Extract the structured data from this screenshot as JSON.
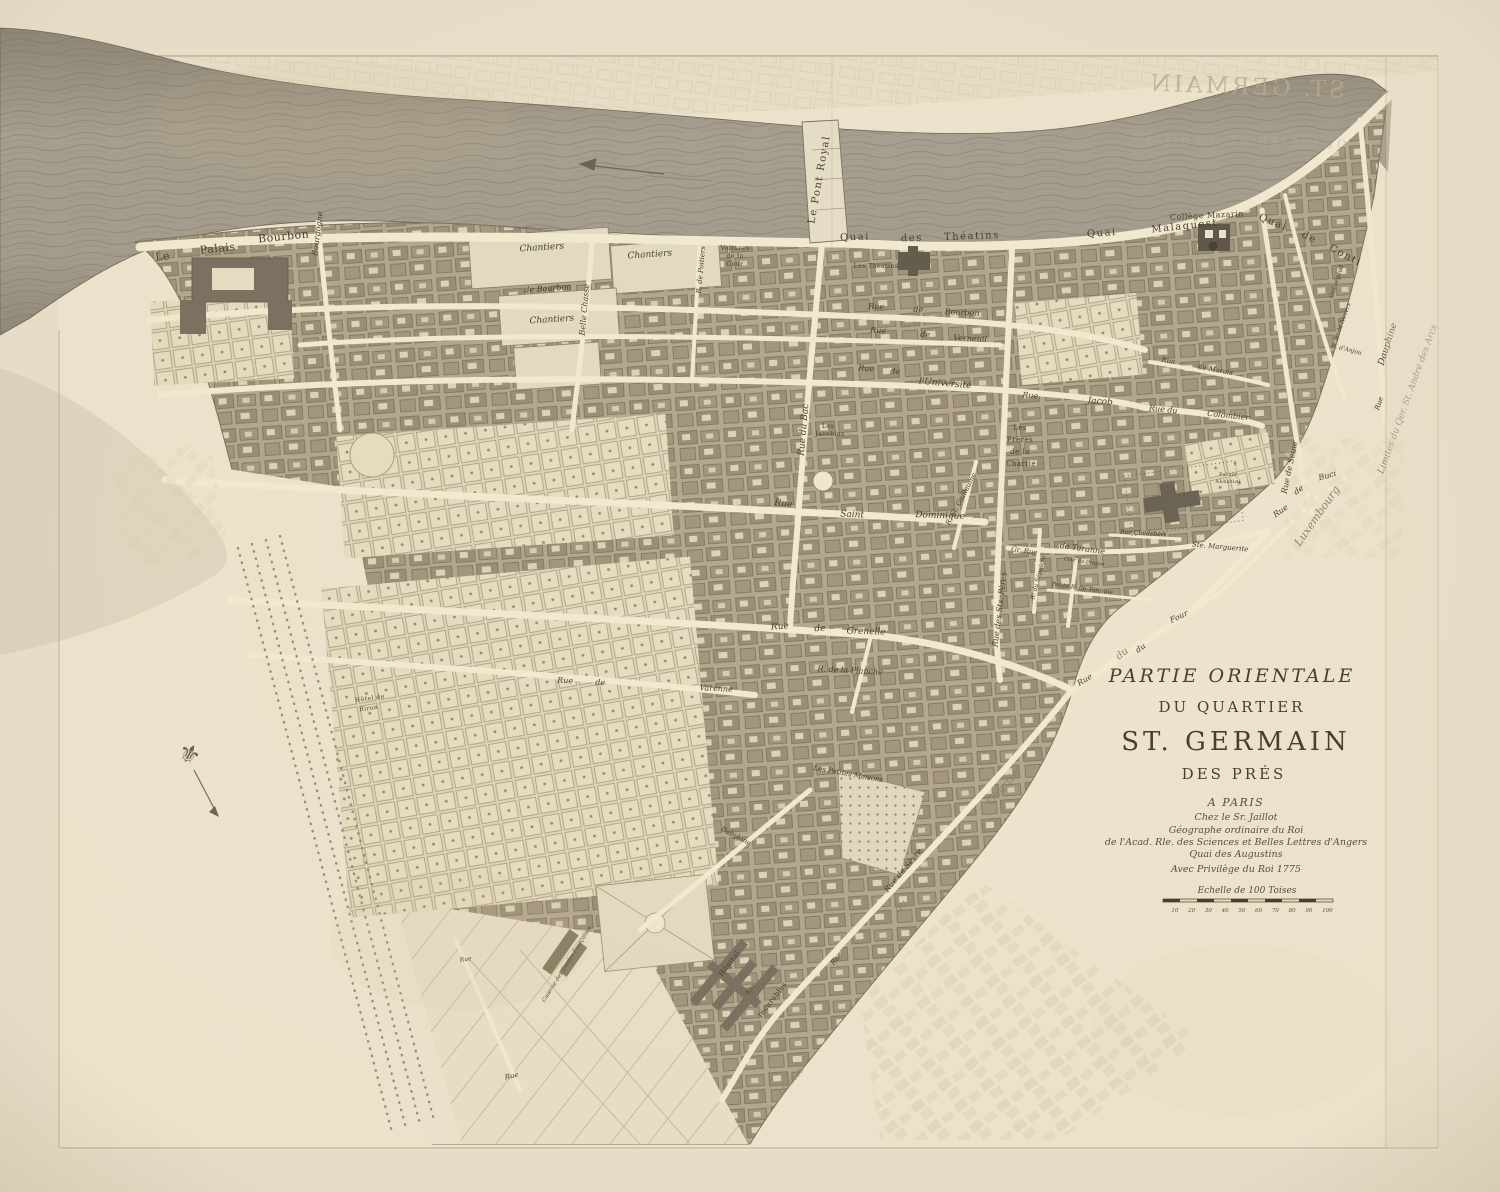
{
  "title": {
    "line1": "PARTIE ORIENTALE",
    "line2": "DU QUARTIER",
    "line3": "ST. GERMAIN",
    "line4": "DES PRÉS",
    "imprint": [
      "A PARIS",
      "Chez le Sr. Jaillot",
      "Géographe ordinaire du Roi",
      "de l'Acad. Rle. des Sciences et Belles Lettres d'Angers",
      "Quai des Augustins",
      "Avec Privilège du Roi 1775"
    ],
    "scale_label": "Echelle de 100 Toises",
    "scale_ticks": "10 20 30 40 50 60 70 80 90 100"
  },
  "colors": {
    "paper": "#e9dfc9",
    "sheet": "#eee4cd",
    "river": "#a79f8f",
    "blocks": "#b3a78d",
    "streets": "#f2e9d1",
    "ink": "#453f2f",
    "ghost_ink": "#b9ad90"
  },
  "show_through": [
    {
      "t": "ST. GERMAIN",
      "x": 1246,
      "y": 94,
      "r": 2,
      "s": 23,
      "mir": true,
      "o": 0.8
    },
    {
      "t": "QUARTIER ST. GERMAIN",
      "x": 1238,
      "y": 145,
      "r": 2,
      "s": 12,
      "mir": true,
      "o": 0.45
    }
  ],
  "labels": [
    {
      "t": "Le",
      "x": 163,
      "y": 260,
      "r": -6,
      "s": 11,
      "c": "p"
    },
    {
      "t": "Palais",
      "x": 218,
      "y": 252,
      "r": -6,
      "s": 11,
      "c": "p"
    },
    {
      "t": "Bourbon",
      "x": 284,
      "y": 240,
      "r": -6,
      "s": 11,
      "c": "p"
    },
    {
      "t": "Bourgogne",
      "x": 320,
      "y": 234,
      "r": -83,
      "s": 8,
      "c": "s"
    },
    {
      "t": "Chantiers",
      "x": 542,
      "y": 250,
      "r": -4,
      "s": 9,
      "c": "s"
    },
    {
      "t": "Chantiers",
      "x": 650,
      "y": 257,
      "r": -4,
      "s": 9,
      "c": "s"
    },
    {
      "t": "de Bourbon",
      "x": 548,
      "y": 291,
      "r": -4,
      "s": 8,
      "c": "s"
    },
    {
      "t": "Chantiers",
      "x": 552,
      "y": 322,
      "r": -4,
      "s": 9,
      "c": "s"
    },
    {
      "t": "Belle Chasse",
      "x": 587,
      "y": 310,
      "r": -85,
      "s": 8,
      "c": "s"
    },
    {
      "t": "Voitures",
      "x": 735,
      "y": 250,
      "r": 0,
      "s": 6,
      "c": "p"
    },
    {
      "t": "de la",
      "x": 735,
      "y": 258,
      "r": 0,
      "s": 6,
      "c": "p"
    },
    {
      "t": "Cour",
      "x": 735,
      "y": 266,
      "r": 0,
      "s": 6,
      "c": "p"
    },
    {
      "t": "R. de Poitiers",
      "x": 703,
      "y": 270,
      "r": -85,
      "s": 7,
      "c": "s"
    },
    {
      "t": "Les Theatins",
      "x": 876,
      "y": 268,
      "r": 0,
      "s": 6,
      "c": "p"
    },
    {
      "t": "Collège Mazarin",
      "x": 1207,
      "y": 218,
      "r": -3,
      "s": 8,
      "c": "p"
    },
    {
      "t": "Quai",
      "x": 855,
      "y": 240,
      "r": -2,
      "s": 10,
      "c": "q"
    },
    {
      "t": "des",
      "x": 912,
      "y": 241,
      "r": -2,
      "s": 10,
      "c": "q"
    },
    {
      "t": "Théatins",
      "x": 972,
      "y": 239,
      "r": -2,
      "s": 10,
      "c": "q"
    },
    {
      "t": "Quai",
      "x": 1102,
      "y": 236,
      "r": -4,
      "s": 10,
      "c": "q"
    },
    {
      "t": "Malaquest",
      "x": 1185,
      "y": 229,
      "r": -6,
      "s": 10,
      "c": "q"
    },
    {
      "t": "Quai",
      "x": 1272,
      "y": 225,
      "r": 22,
      "s": 10,
      "c": "q"
    },
    {
      "t": "de",
      "x": 1308,
      "y": 240,
      "r": 25,
      "s": 10,
      "c": "q"
    },
    {
      "t": "Conti",
      "x": 1344,
      "y": 258,
      "r": 28,
      "s": 10,
      "c": "q"
    },
    {
      "t": "Le Pont Royal",
      "x": 822,
      "y": 180,
      "r": -80,
      "s": 10,
      "c": "q"
    },
    {
      "t": "Rue",
      "x": 876,
      "y": 309,
      "r": 3,
      "s": 8,
      "c": "s"
    },
    {
      "t": "de",
      "x": 918,
      "y": 312,
      "r": 3,
      "s": 8,
      "c": "s"
    },
    {
      "t": "Bourbon",
      "x": 962,
      "y": 315,
      "r": 3,
      "s": 8,
      "c": "s"
    },
    {
      "t": "Rue",
      "x": 878,
      "y": 333,
      "r": 3,
      "s": 8,
      "c": "s"
    },
    {
      "t": "de",
      "x": 925,
      "y": 337,
      "r": 3,
      "s": 8,
      "c": "s"
    },
    {
      "t": "Verneuil",
      "x": 970,
      "y": 341,
      "r": 3,
      "s": 8,
      "c": "s"
    },
    {
      "t": "Rue",
      "x": 866,
      "y": 371,
      "r": 4,
      "s": 8,
      "c": "s"
    },
    {
      "t": "de",
      "x": 895,
      "y": 374,
      "r": 4,
      "s": 8,
      "c": "s"
    },
    {
      "t": "l'Université",
      "x": 945,
      "y": 386,
      "r": 5,
      "s": 9,
      "c": "s"
    },
    {
      "t": "Rue",
      "x": 1030,
      "y": 398,
      "r": 4,
      "s": 8,
      "c": "s"
    },
    {
      "t": "Jacob",
      "x": 1100,
      "y": 404,
      "r": 4,
      "s": 9,
      "c": "s"
    },
    {
      "t": "Rue",
      "x": 1168,
      "y": 363,
      "r": 10,
      "s": 7,
      "c": "s"
    },
    {
      "t": "de Marais",
      "x": 1215,
      "y": 372,
      "r": 10,
      "s": 7,
      "c": "s"
    },
    {
      "t": "Rue du",
      "x": 1163,
      "y": 412,
      "r": 6,
      "s": 8,
      "c": "s"
    },
    {
      "t": "Colombier",
      "x": 1228,
      "y": 418,
      "r": 6,
      "s": 8,
      "c": "s"
    },
    {
      "t": "Rue du Bac",
      "x": 806,
      "y": 430,
      "r": -85,
      "s": 9,
      "c": "s"
    },
    {
      "t": "Guénégaud",
      "x": 1338,
      "y": 282,
      "r": -72,
      "s": 6,
      "c": "s"
    },
    {
      "t": "R. de Nevers",
      "x": 1344,
      "y": 322,
      "r": -70,
      "s": 6,
      "c": "s"
    },
    {
      "t": "R. d'Anjou",
      "x": 1346,
      "y": 351,
      "r": 14,
      "s": 6,
      "c": "s"
    },
    {
      "t": "Rue",
      "x": 1381,
      "y": 404,
      "r": -72,
      "s": 7,
      "c": "s"
    },
    {
      "t": "Dauphine",
      "x": 1390,
      "y": 345,
      "r": -72,
      "s": 9,
      "c": "s"
    },
    {
      "t": "Limites du Qer. St. André des Arcs",
      "x": 1410,
      "y": 400,
      "r": -70,
      "s": 9,
      "c": "g"
    },
    {
      "t": "Les",
      "x": 828,
      "y": 428,
      "r": 0,
      "s": 6,
      "c": "p"
    },
    {
      "t": "Jacobins",
      "x": 830,
      "y": 436,
      "r": 0,
      "s": 6,
      "c": "p"
    },
    {
      "t": "Les",
      "x": 1020,
      "y": 430,
      "r": 0,
      "s": 7,
      "c": "p"
    },
    {
      "t": "Frères",
      "x": 1020,
      "y": 442,
      "r": 0,
      "s": 7,
      "c": "p"
    },
    {
      "t": "de la",
      "x": 1020,
      "y": 454,
      "r": 0,
      "s": 7,
      "c": "p"
    },
    {
      "t": "Charité",
      "x": 1021,
      "y": 466,
      "r": 0,
      "s": 7,
      "c": "p"
    },
    {
      "t": "Rue",
      "x": 783,
      "y": 506,
      "r": 8,
      "s": 9,
      "c": "s"
    },
    {
      "t": "Saint",
      "x": 852,
      "y": 517,
      "r": 3,
      "s": 9,
      "c": "s"
    },
    {
      "t": "Dominique",
      "x": 940,
      "y": 518,
      "r": 2,
      "s": 9,
      "c": "s"
    },
    {
      "t": "R. St. Guillaume",
      "x": 963,
      "y": 500,
      "r": -62,
      "s": 7,
      "c": "s"
    },
    {
      "t": "Palais",
      "x": 1228,
      "y": 476,
      "r": 0,
      "s": 5,
      "c": "p"
    },
    {
      "t": "Abbatial",
      "x": 1228,
      "y": 483,
      "r": 0,
      "s": 5,
      "c": "p"
    },
    {
      "t": "Rue",
      "x": 1282,
      "y": 513,
      "r": -35,
      "s": 8,
      "c": "s"
    },
    {
      "t": "de",
      "x": 1300,
      "y": 492,
      "r": -35,
      "s": 8,
      "c": "s"
    },
    {
      "t": "Buci",
      "x": 1328,
      "y": 478,
      "r": -15,
      "s": 8,
      "c": "s"
    },
    {
      "t": "Rue de Seine",
      "x": 1292,
      "y": 468,
      "r": -78,
      "s": 8,
      "c": "s"
    },
    {
      "t": "Rue Childebert",
      "x": 1143,
      "y": 535,
      "r": 3,
      "s": 6,
      "c": "s"
    },
    {
      "t": "Ste. Marguerite",
      "x": 1220,
      "y": 549,
      "r": 5,
      "s": 7,
      "c": "s"
    },
    {
      "t": "Gr. Rue",
      "x": 1024,
      "y": 553,
      "r": 8,
      "s": 7,
      "c": "s"
    },
    {
      "t": "de Taranne",
      "x": 1082,
      "y": 551,
      "r": 8,
      "s": 8,
      "c": "s"
    },
    {
      "t": "Cour du Dragon",
      "x": 1084,
      "y": 563,
      "r": 8,
      "s": 5,
      "c": "s"
    },
    {
      "t": "Petite R. de Taranne",
      "x": 1082,
      "y": 590,
      "r": 8,
      "s": 6,
      "c": "s"
    },
    {
      "t": "R. du Sépulcre",
      "x": 1040,
      "y": 578,
      "r": -75,
      "s": 6,
      "c": "s"
    },
    {
      "t": "Rue des Sts. Pères",
      "x": 1002,
      "y": 610,
      "r": -83,
      "s": 8,
      "c": "s"
    },
    {
      "t": "Rue",
      "x": 780,
      "y": 629,
      "r": -3,
      "s": 9,
      "c": "s"
    },
    {
      "t": "de",
      "x": 820,
      "y": 631,
      "r": -3,
      "s": 9,
      "c": "s"
    },
    {
      "t": "Grenelle",
      "x": 866,
      "y": 634,
      "r": 2,
      "s": 9,
      "c": "s"
    },
    {
      "t": "R. de la Planche",
      "x": 850,
      "y": 673,
      "r": 3,
      "s": 8,
      "c": "s"
    },
    {
      "t": "Rue",
      "x": 565,
      "y": 683,
      "r": 3,
      "s": 8,
      "c": "s"
    },
    {
      "t": "de",
      "x": 600,
      "y": 685,
      "r": 3,
      "s": 8,
      "c": "s"
    },
    {
      "t": "Varenne",
      "x": 716,
      "y": 691,
      "r": 3,
      "s": 8,
      "c": "s"
    },
    {
      "t": "Hôtel de",
      "x": 370,
      "y": 700,
      "r": -8,
      "s": 6,
      "c": "p"
    },
    {
      "t": "Biron",
      "x": 369,
      "y": 710,
      "r": -8,
      "s": 6,
      "c": "p"
    },
    {
      "t": "Les Petites Maisons",
      "x": 848,
      "y": 776,
      "r": 10,
      "s": 7,
      "c": "s"
    },
    {
      "t": "Babylone",
      "x": 735,
      "y": 838,
      "r": 28,
      "s": 7,
      "c": "s"
    },
    {
      "t": "Rue de Sèvre",
      "x": 905,
      "y": 872,
      "r": -50,
      "s": 8,
      "c": "s"
    },
    {
      "t": "Four",
      "x": 1180,
      "y": 619,
      "r": -25,
      "s": 8,
      "c": "s"
    },
    {
      "t": "du",
      "x": 1142,
      "y": 650,
      "r": -35,
      "s": 8,
      "c": "s"
    },
    {
      "t": "Rue",
      "x": 1086,
      "y": 682,
      "r": -32,
      "s": 8,
      "c": "s"
    },
    {
      "t": "Caserne des Gardes Françaises",
      "x": 568,
      "y": 965,
      "r": -58,
      "s": 5.5,
      "c": "s"
    },
    {
      "t": "Hôpital",
      "x": 731,
      "y": 965,
      "r": -52,
      "s": 7,
      "c": "p"
    },
    {
      "t": "des",
      "x": 752,
      "y": 990,
      "r": -52,
      "s": 6,
      "c": "p"
    },
    {
      "t": "Incurables",
      "x": 774,
      "y": 1001,
      "r": -52,
      "s": 7,
      "c": "p"
    },
    {
      "t": "Rue",
      "x": 838,
      "y": 960,
      "r": -52,
      "s": 7,
      "c": "s"
    },
    {
      "t": "Rue",
      "x": 512,
      "y": 1078,
      "r": -12,
      "s": 7,
      "c": "s"
    },
    {
      "t": "Rue",
      "x": 466,
      "y": 961,
      "r": -10,
      "s": 6,
      "c": "s"
    },
    {
      "t": "Limites",
      "x": 793,
      "y": 1083,
      "r": -50,
      "s": 9,
      "c": "g"
    },
    {
      "t": "du",
      "x": 903,
      "y": 908,
      "r": -48,
      "s": 10,
      "c": "g"
    },
    {
      "t": "Quartier",
      "x": 1007,
      "y": 788,
      "r": -48,
      "s": 11,
      "c": "g"
    },
    {
      "t": "Luxembourg",
      "x": 1320,
      "y": 518,
      "r": -55,
      "s": 11,
      "c": "g"
    },
    {
      "t": "du",
      "x": 1124,
      "y": 656,
      "r": -40,
      "s": 10,
      "c": "g"
    }
  ]
}
